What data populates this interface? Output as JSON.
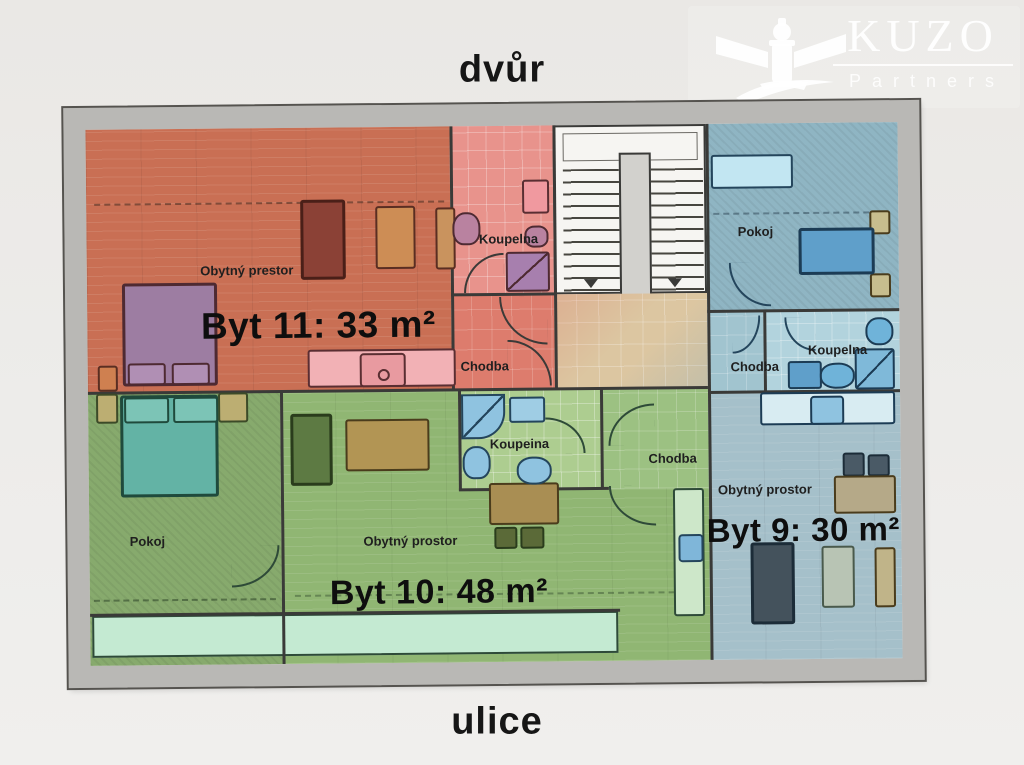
{
  "page": {
    "top_label": "dvůr",
    "bottom_label": "ulice"
  },
  "logo": {
    "brand": "KUZO",
    "brand_sub": "Partners",
    "icon": "lighthouse-icon"
  },
  "plan": {
    "byt11": {
      "name_label": "Byt 11: 33 m²",
      "living_label": "Obytný prestor",
      "bathroom_label": "Koupelna",
      "hall_label": "Chodba",
      "color": "#c96f54"
    },
    "byt10": {
      "name_label": "Byt 10: 48 m²",
      "living_label": "Obytný prostor",
      "bathroom_label": "Koupeina",
      "hall_label": "Chodba",
      "room_label": "Pokoj",
      "color": "#90b673"
    },
    "byt9": {
      "name_label": "Byt 9: 30 m²",
      "living_label": "Obytný prostor",
      "bathroom_label": "Koupelna",
      "hall_label": "Chodba",
      "room_label": "Pokoj",
      "color": "#a5c0ca"
    },
    "landing_color": "#dcc6a1"
  }
}
